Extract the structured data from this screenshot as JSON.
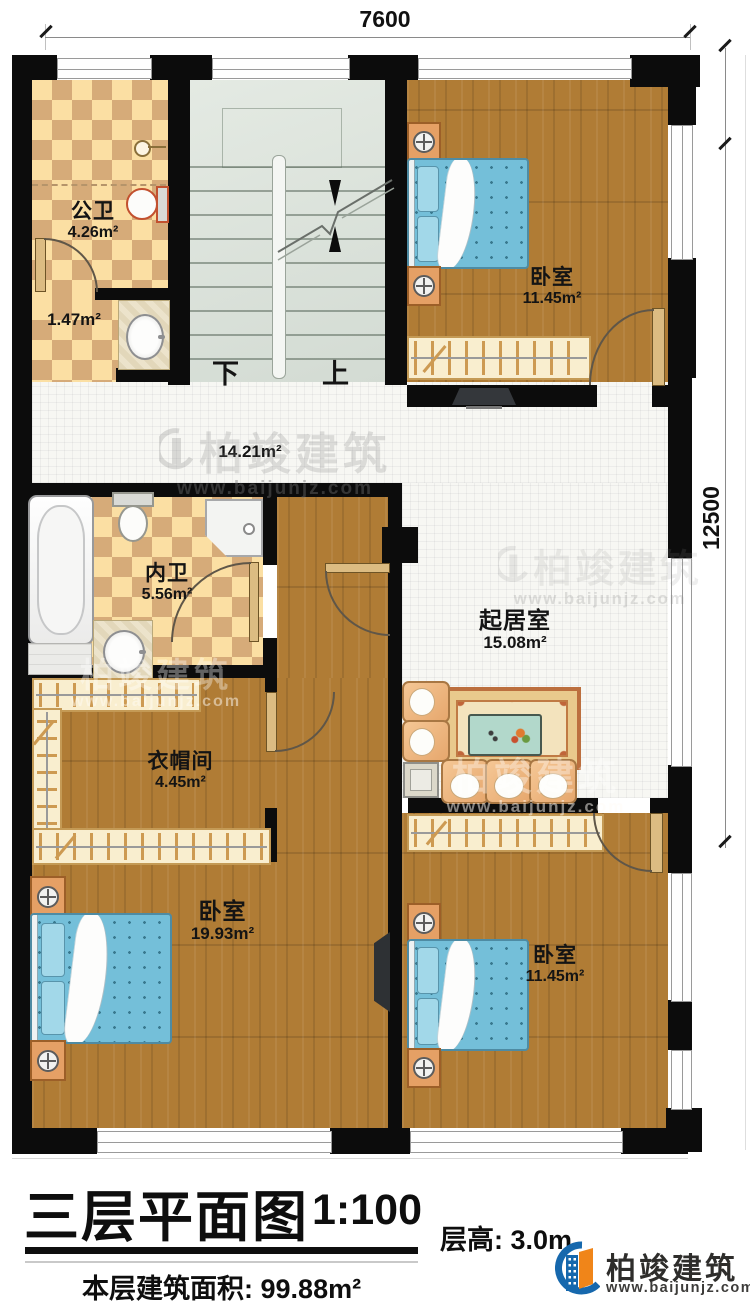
{
  "title_block": {
    "plan_title": "三层平面图",
    "scale": "1:100",
    "floor_height_label": "层高:",
    "floor_height_value": "3.0m",
    "floor_area_label": "本层建筑面积:",
    "floor_area_value": "99.88m²"
  },
  "dimensions": {
    "top_width": "7600",
    "right_height": "12500"
  },
  "stairs": {
    "down_label": "下",
    "up_label": "上"
  },
  "rooms": {
    "public_bath": {
      "name": "公卫",
      "area": "4.26m²"
    },
    "bath_vestibule": {
      "area": "1.47m²"
    },
    "hallway": {
      "area": "14.21m²"
    },
    "master_bath": {
      "name": "内卫",
      "area": "5.56m²"
    },
    "living": {
      "name": "起居室",
      "area": "15.08m²"
    },
    "cloakroom": {
      "name": "衣帽间",
      "area": "4.45m²"
    },
    "bedroom_top_right": {
      "name": "卧室",
      "area": "11.45m²"
    },
    "bedroom_bottom_left": {
      "name": "卧室",
      "area": "19.93m²"
    },
    "bedroom_bottom_right": {
      "name": "卧室",
      "area": "11.45m²"
    }
  },
  "branding": {
    "company": "柏竣建筑",
    "website": "www.baijunjz.com"
  },
  "watermark": {
    "text": "柏竣建筑",
    "url": "www.baijunjz.com"
  },
  "colors": {
    "wall": "#0c0c0c",
    "wood_floor": "#b07c35",
    "tile": "#f7f7f3",
    "checker_light": "#fbdfa3",
    "checker_dark": "#d6ab79",
    "stair": "#dce3dc",
    "bed": "#74bfd9",
    "logo_blue": "#1668ad",
    "logo_orange": "#f08519"
  }
}
